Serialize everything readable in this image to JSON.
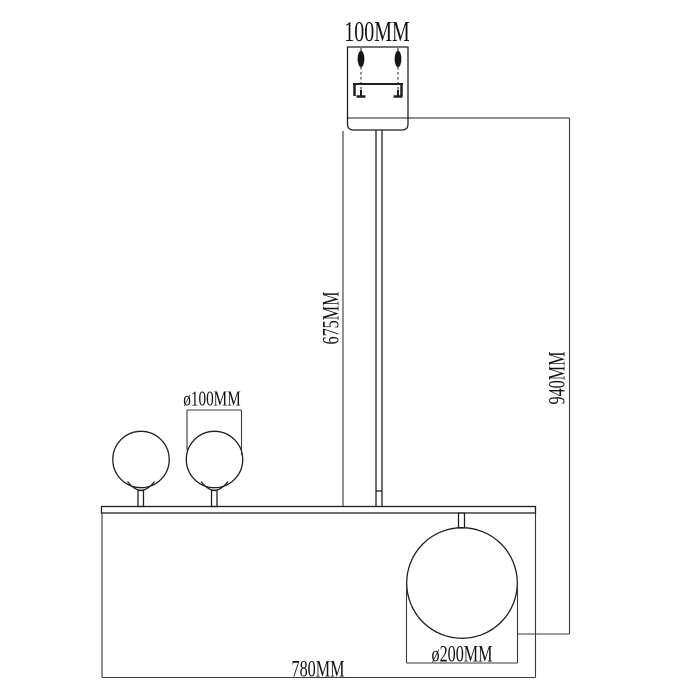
{
  "drawing": {
    "background_color": "#ffffff",
    "line_color": "#1f1f1f",
    "dimension_line_color": "#3a3a3a",
    "labels": {
      "canopy_width": "100MM",
      "rod_length": "675MM",
      "overall_height": "940MM",
      "small_globe_diameter": "ø100MM",
      "large_globe_diameter": "ø200MM",
      "fixture_width": "780MM"
    },
    "dimensions_mm": {
      "canopy_width": 100,
      "rod_length": 675,
      "overall_height": 940,
      "small_globe_diameter": 100,
      "large_globe_diameter": 200,
      "fixture_width": 780
    }
  }
}
